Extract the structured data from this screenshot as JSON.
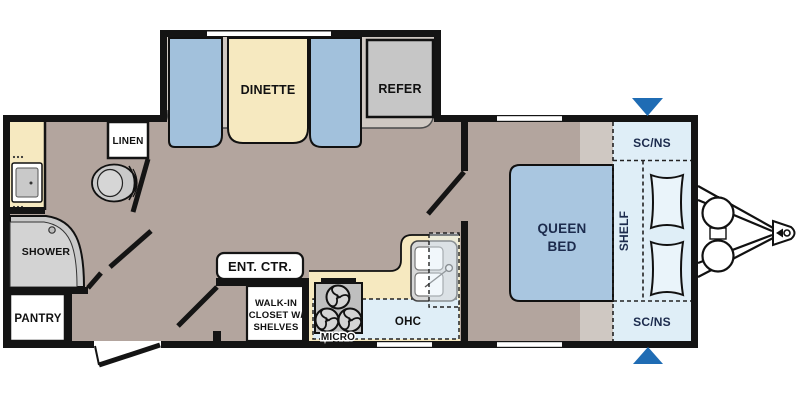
{
  "meta": {
    "title": "Travel Trailer Floor Plan",
    "width": 800,
    "height": 400
  },
  "colors": {
    "wall": "#141414",
    "floor": "#b3a59e",
    "slide_floor": "#cfc8c2",
    "cream": "#f6e9c0",
    "bench_blue": "#a2c1dc",
    "bed_blue": "#a9c6e0",
    "light_blue": "#dfeef7",
    "pillow_fill": "#eaf4fa",
    "appliance_gray": "#c6c6c6",
    "shower_gray": "#c9c9c9",
    "stove_gray": "#bfbfbf",
    "sink_gray": "#d8d8d8",
    "arrow_blue": "#1f6cb4",
    "navy_text": "#1c2b4d",
    "black_text": "#111111"
  },
  "labels": {
    "dinette": "DINETTE",
    "refrigerator": "REFER",
    "linen": "LINEN",
    "shower": "SHOWER",
    "pantry": "PANTRY",
    "entertainment_center": "ENT. CTR.",
    "walk_in_closet_line1": "WALK-IN",
    "walk_in_closet_line2": "CLOSET W/",
    "walk_in_closet_line3": "SHELVES",
    "microwave": "MICRO",
    "overhead_cabinet": "OHC",
    "queen_bed_line1": "QUEEN",
    "queen_bed_line2": "BED",
    "shelf": "SHELF",
    "sc_ns_top": "SC/NS",
    "sc_ns_bottom": "SC/NS"
  }
}
